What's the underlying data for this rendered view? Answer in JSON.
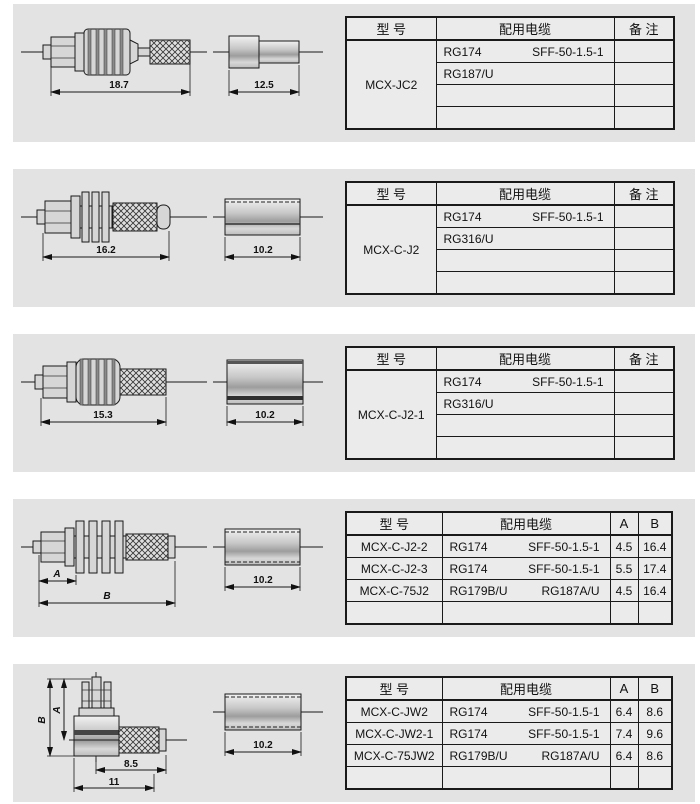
{
  "panels": [
    {
      "model": "MCX-JC2",
      "table": {
        "headers": {
          "model": "型  号",
          "cable": "配用电缆",
          "remark": "备  注"
        },
        "cable_rows": [
          {
            "c1": "RG174",
            "c2": "SFF-50-1.5-1"
          },
          {
            "c1": "RG187/U",
            "c2": ""
          },
          {
            "c1": "",
            "c2": ""
          },
          {
            "c1": "",
            "c2": ""
          }
        ]
      },
      "dims": {
        "main": "18.7",
        "ferrule": "12.5"
      }
    },
    {
      "model": "MCX-C-J2",
      "table": {
        "headers": {
          "model": "型  号",
          "cable": "配用电缆",
          "remark": "备  注"
        },
        "cable_rows": [
          {
            "c1": "RG174",
            "c2": "SFF-50-1.5-1"
          },
          {
            "c1": "RG316/U",
            "c2": ""
          },
          {
            "c1": "",
            "c2": ""
          },
          {
            "c1": "",
            "c2": ""
          }
        ]
      },
      "dims": {
        "main": "16.2",
        "ferrule": "10.2"
      }
    },
    {
      "model": "MCX-C-J2-1",
      "table": {
        "headers": {
          "model": "型  号",
          "cable": "配用电缆",
          "remark": "备  注"
        },
        "cable_rows": [
          {
            "c1": "RG174",
            "c2": "SFF-50-1.5-1"
          },
          {
            "c1": "RG316/U",
            "c2": ""
          },
          {
            "c1": "",
            "c2": ""
          },
          {
            "c1": "",
            "c2": ""
          }
        ]
      },
      "dims": {
        "main": "15.3",
        "ferrule": "10.2"
      }
    },
    {
      "table": {
        "headers": {
          "model": "型  号",
          "cable": "配用电缆",
          "a": "A",
          "b": "B"
        },
        "rows": [
          {
            "model": "MCX-C-J2-2",
            "c1": "RG174",
            "c2": "SFF-50-1.5-1",
            "a": "4.5",
            "b": "16.4"
          },
          {
            "model": "MCX-C-J2-3",
            "c1": "RG174",
            "c2": "SFF-50-1.5-1",
            "a": "5.5",
            "b": "17.4"
          },
          {
            "model": "MCX-C-75J2",
            "c1": "RG179B/U",
            "c2": "RG187A/U",
            "a": "4.5",
            "b": "16.4"
          },
          {
            "model": "",
            "c1": "",
            "c2": "",
            "a": "",
            "b": ""
          }
        ]
      },
      "dims": {
        "a": "A",
        "b": "B",
        "ferrule": "10.2"
      }
    },
    {
      "table": {
        "headers": {
          "model": "型  号",
          "cable": "配用电缆",
          "a": "A",
          "b": "B"
        },
        "rows": [
          {
            "model": "MCX-C-JW2",
            "c1": "RG174",
            "c2": "SFF-50-1.5-1",
            "a": "6.4",
            "b": "8.6"
          },
          {
            "model": "MCX-C-JW2-1",
            "c1": "RG174",
            "c2": "SFF-50-1.5-1",
            "a": "7.4",
            "b": "9.6"
          },
          {
            "model": "MCX-C-75JW2",
            "c1": "RG179B/U",
            "c2": "RG187A/U",
            "a": "6.4",
            "b": "8.6"
          },
          {
            "model": "",
            "c1": "",
            "c2": "",
            "a": "",
            "b": ""
          }
        ]
      },
      "dims": {
        "a": "A",
        "b": "B",
        "w1": "8.5",
        "w2": "11",
        "ferrule": "10.2"
      }
    }
  ]
}
